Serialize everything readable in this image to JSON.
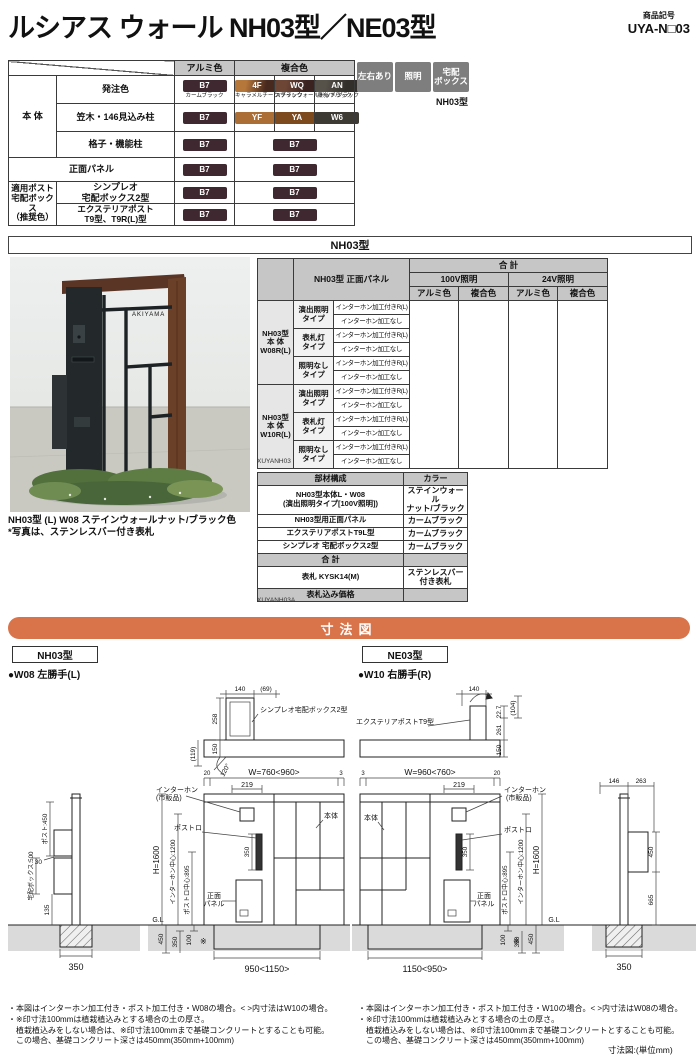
{
  "header": {
    "title": "ルシアス ウォール NH03型／NE03型",
    "code_label": "商品記号",
    "code": "UYA-N□03"
  },
  "badges": {
    "b1": "左右あり",
    "b2": "照明",
    "b3": "宅配\nボックス",
    "note": "NH03型"
  },
  "color_table": {
    "col_alumi": "アルミ色",
    "col_fukugo": "複合色",
    "row_hontai": "本 体",
    "row_hacchu": "発注色",
    "row_kasagi": "笠木・146見込み柱",
    "row_koshi": "格子・機能柱",
    "row_shomen": "正面パネル",
    "row_tekiyo": "適用ポスト\n宅配ボックス\n（推奨色）",
    "row_simpleo": "シンプレオ\n宅配ボックス2型",
    "row_exterior": "エクステリアポスト\nT9型、T9R(L)型",
    "b7": {
      "code": "B7",
      "name": "カームブラック",
      "color": "#3f2830"
    },
    "f4": {
      "code": "4F",
      "name": "キャラメルチーク/ブラック",
      "color": "linear-gradient(100deg,#b5773a 25%,#47291e 70%)"
    },
    "wq": {
      "code": "WQ",
      "name": "ステインウォールナット/ブラック",
      "color": "linear-gradient(100deg,#6e4636 25%,#3a2220 70%)"
    },
    "an": {
      "code": "AN",
      "name": "桑炭/ブラック",
      "color": "linear-gradient(100deg,#56524a 25%,#322e2a 70%)"
    },
    "yf": {
      "code": "YF",
      "color": "#ab6f36"
    },
    "ya": {
      "code": "YA",
      "color": "#7d4a1d"
    },
    "w6": {
      "code": "W6",
      "color": "#3d3933"
    }
  },
  "section2": {
    "title": "NH03型"
  },
  "photo": {
    "nameplate": "AKIYAMA",
    "caption1": "NH03型 (L) W08 ステインウォールナット/ブラック色",
    "caption2": "*写真は、ステンレスバー付き表札"
  },
  "price_table": {
    "panel_header": "NH03型 正面パネル",
    "total": "合 計",
    "v100": "100V照明",
    "v24": "24V照明",
    "alumi": "アルミ色",
    "fukugo": "複合色",
    "group1": "NH03型\n本 体\nW08R(L)",
    "group2": "NH03型\n本 体\nW10R(L)",
    "type1": "演出照明\nタイプ",
    "type2": "表札灯\nタイプ",
    "type3": "照明なし\nタイプ",
    "va": "インターホン加工付きR(L)",
    "vb": "インターホン加工なし",
    "code": "XUYANH03"
  },
  "parts_table": {
    "h1": "部材構成",
    "h2": "カラー",
    "r1n": "NH03型本体L・W08\n(演出照明タイプ[100V照明])",
    "r1c": "ステインウォール\nナット/ブラック",
    "r2n": "NH03型用正面パネル",
    "r2c": "カームブラック",
    "r3n": "エクステリアポストT9L型",
    "r3c": "カームブラック",
    "r4n": "シンプレオ 宅配ボックス2型",
    "r4c": "カームブラック",
    "r5n": "合 計",
    "r5c": "",
    "r6n": "表札 KYSK14(M)",
    "r6c": "ステンレスバー\n付き表札",
    "r7n": "表札込み価格",
    "r7c": "",
    "code": "XUYANH03A"
  },
  "dims": {
    "title": "寸法図",
    "unit": "寸法図:(単位mm)",
    "left": {
      "model": "NH03型",
      "variant": "●W08 左勝手(L)",
      "plan": {
        "d140": "140",
        "d69": "(69)",
        "box": "シンプレオ宅配ボックス2型",
        "d258": "258",
        "d150": "150",
        "d119": "(119)",
        "angle": "120°"
      },
      "front": {
        "d20": "20",
        "w": "W=760<960>",
        "d3": "3",
        "d219": "219",
        "iph1": "インターホン",
        "iph2": "(市販品)",
        "slot": "ポストロ",
        "slot_h": "350",
        "h": "H=1600",
        "ic": "インターホン中心:1200",
        "pc": "ポストロ中心:895",
        "panel1": "正面",
        "panel2": "パネル",
        "body": "本体",
        "gl": "G.L",
        "d450": "450",
        "d350": "350",
        "d100": "100",
        "mark": "※",
        "bw": "950<1150>"
      },
      "side": {
        "post": "ポスト:450",
        "d30": "30",
        "box": "宅配ボックス:500",
        "d135": "135",
        "bw": "350"
      },
      "notes": [
        "・本図はインターホン加工付き・ポスト加工付き・W08の場合。< >内寸法はW10の場合。",
        "・※印寸法100mmは植栽植込みとする場合の土の厚さ。",
        "　植栽植込みをしない場合は、※印寸法100mmまで基礎コンクリートとすることも可能。",
        "　この場合、基礎コンクリート深さは450mm(350mm+100mm)"
      ]
    },
    "right": {
      "model": "NE03型",
      "variant": "●W10 右勝手(R)",
      "plan": {
        "box": "エクステリアポストT9型",
        "d140": "140",
        "d227": "22.7",
        "d104": "(104)",
        "d261": "261",
        "d150": "150"
      },
      "front": {
        "d3": "3",
        "w": "W=960<760>",
        "d20": "20",
        "d219": "219",
        "iph1": "インターホン",
        "iph2": "(市販品)",
        "slot": "ポストロ",
        "slot_h": "350",
        "h": "H=1600",
        "ic": "インターホン中心:1200",
        "pc": "ポストロ中心:895",
        "panel1": "正面",
        "panel2": "パネル",
        "body": "本体",
        "gl": "G.L",
        "d100": "100",
        "mark": "※",
        "d350": "350",
        "d450": "450",
        "bw": "1150<950>"
      },
      "side": {
        "d146": "146",
        "d263": "263",
        "d450": "450",
        "d665": "665",
        "bw": "350"
      },
      "notes": [
        "・本図はインターホン加工付き・ポスト加工付き・W10の場合。< >内寸法はW08の場合。",
        "・※印寸法100mmは植栽植込みとする場合の土の厚さ。",
        "　植栽植込みをしない場合は、※印寸法100mmまで基礎コンクリートとすることも可能。",
        "　この場合、基礎コンクリート深さは450mm(350mm+100mm)"
      ]
    }
  }
}
